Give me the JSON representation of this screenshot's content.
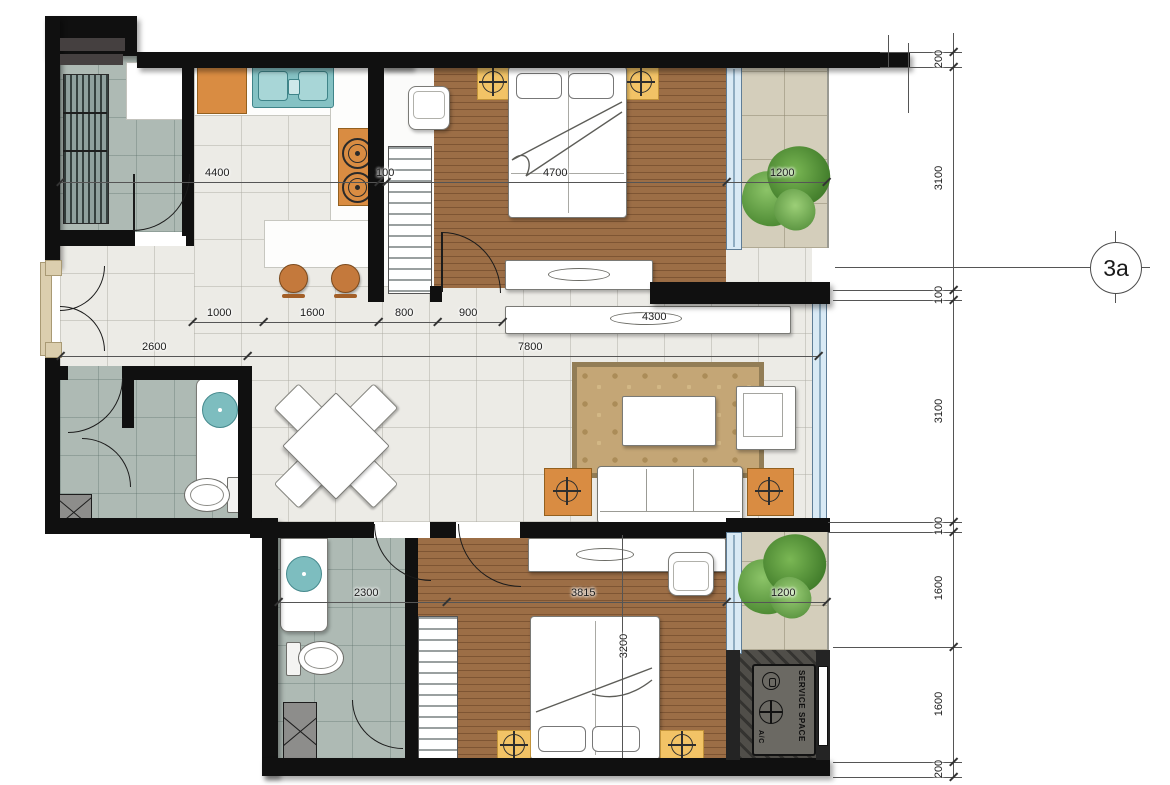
{
  "title": "Apartment unit floor plan",
  "grid_marker": "3a",
  "service_space": {
    "label": "SERVICE SPACE",
    "ac_label": "A/C"
  },
  "dims": {
    "v4400": "4400",
    "v100w": "100",
    "v4700": "4700",
    "v1200a": "1200",
    "v1000": "1000",
    "v1600a": "1600",
    "v800": "800",
    "v900": "900",
    "v4300": "4300",
    "v2600": "2600",
    "v7800": "7800",
    "v2300": "2300",
    "v3815": "3815",
    "v1200b": "1200",
    "v3200": "3200",
    "right_chain": [
      "200",
      "3100",
      "100",
      "3100",
      "100",
      "1600",
      "1600",
      "200"
    ]
  },
  "colors": {
    "wall": "#101010",
    "wood_floor": "#9c6e46",
    "bath_floor": "#aebab4",
    "balcony_floor": "#d4cebb",
    "tile_floor": "#ecebe6",
    "accent_orange": "#d98c42",
    "accent_yellow": "#f2c366",
    "fixture_teal": "#7dbdbf",
    "window_blue": "#d9eaf5",
    "rug_tan": "#c4a676",
    "plant_green": "#5a9440"
  }
}
